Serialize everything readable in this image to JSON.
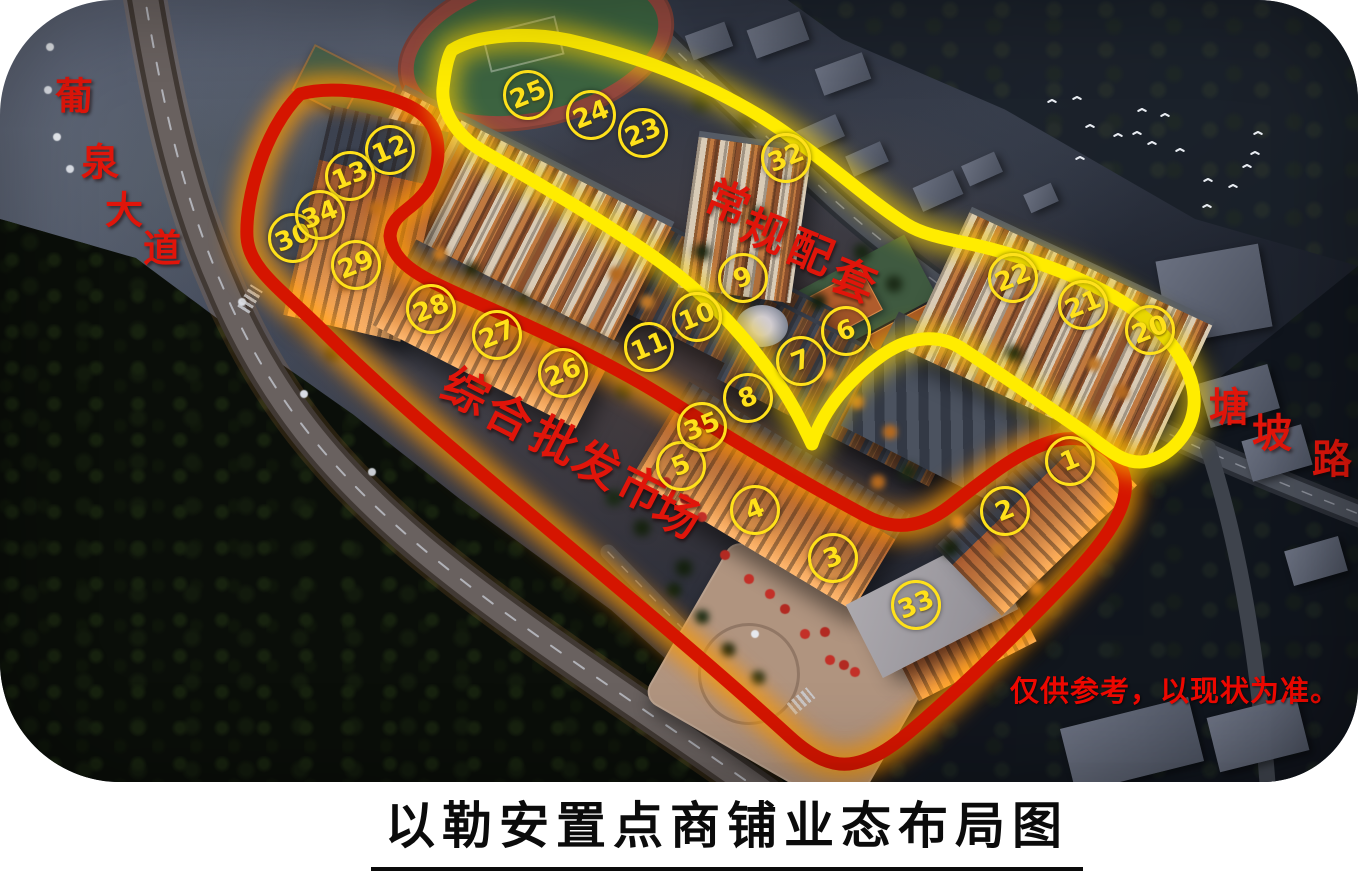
{
  "page": {
    "title": "以勒安置点商铺业态布局图"
  },
  "map": {
    "disclaimer": "仅供参考，以现状为准。",
    "legend_colors": {
      "commercial_loop": "#d51500",
      "amenities_loop": "#ffec00",
      "marker_yellow": "#ffe11a",
      "label_red": "#e0150a",
      "title_black": "#0b0b0b"
    },
    "markers": [
      {
        "label": "1",
        "x": 1067,
        "y": 458
      },
      {
        "label": "2",
        "x": 1002,
        "y": 508
      },
      {
        "label": "3",
        "x": 830,
        "y": 555
      },
      {
        "label": "4",
        "x": 752,
        "y": 507
      },
      {
        "label": "5",
        "x": 678,
        "y": 463
      },
      {
        "label": "6",
        "x": 843,
        "y": 328
      },
      {
        "label": "7",
        "x": 798,
        "y": 358
      },
      {
        "label": "8",
        "x": 745,
        "y": 395
      },
      {
        "label": "9",
        "x": 740,
        "y": 275
      },
      {
        "label": "10",
        "x": 694,
        "y": 314
      },
      {
        "label": "11",
        "x": 646,
        "y": 344
      },
      {
        "label": "12",
        "x": 387,
        "y": 147
      },
      {
        "label": "13",
        "x": 347,
        "y": 173
      },
      {
        "label": "20",
        "x": 1147,
        "y": 327
      },
      {
        "label": "21",
        "x": 1080,
        "y": 302
      },
      {
        "label": "22",
        "x": 1010,
        "y": 275
      },
      {
        "label": "23",
        "x": 640,
        "y": 130
      },
      {
        "label": "24",
        "x": 588,
        "y": 112
      },
      {
        "label": "25",
        "x": 525,
        "y": 92
      },
      {
        "label": "26",
        "x": 560,
        "y": 370
      },
      {
        "label": "27",
        "x": 494,
        "y": 332
      },
      {
        "label": "28",
        "x": 428,
        "y": 306
      },
      {
        "label": "29",
        "x": 353,
        "y": 262
      },
      {
        "label": "30",
        "x": 290,
        "y": 235
      },
      {
        "label": "32",
        "x": 783,
        "y": 155
      },
      {
        "label": "33",
        "x": 913,
        "y": 602
      },
      {
        "label": "34",
        "x": 317,
        "y": 212
      },
      {
        "label": "35",
        "x": 699,
        "y": 424
      }
    ],
    "labels": [
      {
        "name": "road-puquan-avenue",
        "text": "葡泉大道",
        "size": 38,
        "rot": 0,
        "chars": [
          {
            "c": "葡",
            "x": 74,
            "y": 93
          },
          {
            "c": "泉",
            "x": 100,
            "y": 159
          },
          {
            "c": "大",
            "x": 124,
            "y": 207
          },
          {
            "c": "道",
            "x": 162,
            "y": 245
          }
        ]
      },
      {
        "name": "zone-regular-amenities",
        "text": "常规配套",
        "size": 44,
        "rot": 22,
        "chars": [
          {
            "c": "常",
            "x": 729,
            "y": 199
          },
          {
            "c": "规",
            "x": 766,
            "y": 228
          },
          {
            "c": "配",
            "x": 812,
            "y": 249
          },
          {
            "c": "套",
            "x": 855,
            "y": 277
          }
        ]
      },
      {
        "name": "zone-wholesale-market",
        "text": "综合批发市场",
        "size": 46,
        "rot": 27,
        "chars": [
          {
            "c": "综",
            "x": 467,
            "y": 389
          },
          {
            "c": "合",
            "x": 510,
            "y": 414
          },
          {
            "c": "批",
            "x": 556,
            "y": 438
          },
          {
            "c": "发",
            "x": 598,
            "y": 462
          },
          {
            "c": "市",
            "x": 642,
            "y": 487
          },
          {
            "c": "场",
            "x": 678,
            "y": 512
          }
        ]
      },
      {
        "name": "road-tangpo-road",
        "text": "塘坡路",
        "size": 40,
        "rot": 0,
        "chars": [
          {
            "c": "塘",
            "x": 1229,
            "y": 404
          },
          {
            "c": "坡",
            "x": 1272,
            "y": 430
          },
          {
            "c": "路",
            "x": 1332,
            "y": 456
          }
        ]
      }
    ],
    "birds": [
      [
        1072,
        95
      ],
      [
        1137,
        107
      ],
      [
        1160,
        112
      ],
      [
        1085,
        123
      ],
      [
        1113,
        132
      ],
      [
        1132,
        130
      ],
      [
        1147,
        140
      ],
      [
        1175,
        147
      ],
      [
        1253,
        130
      ],
      [
        1250,
        150
      ],
      [
        1242,
        163
      ],
      [
        1203,
        177
      ],
      [
        1228,
        183
      ],
      [
        1202,
        203
      ],
      [
        1075,
        155
      ],
      [
        1047,
        98
      ]
    ]
  }
}
